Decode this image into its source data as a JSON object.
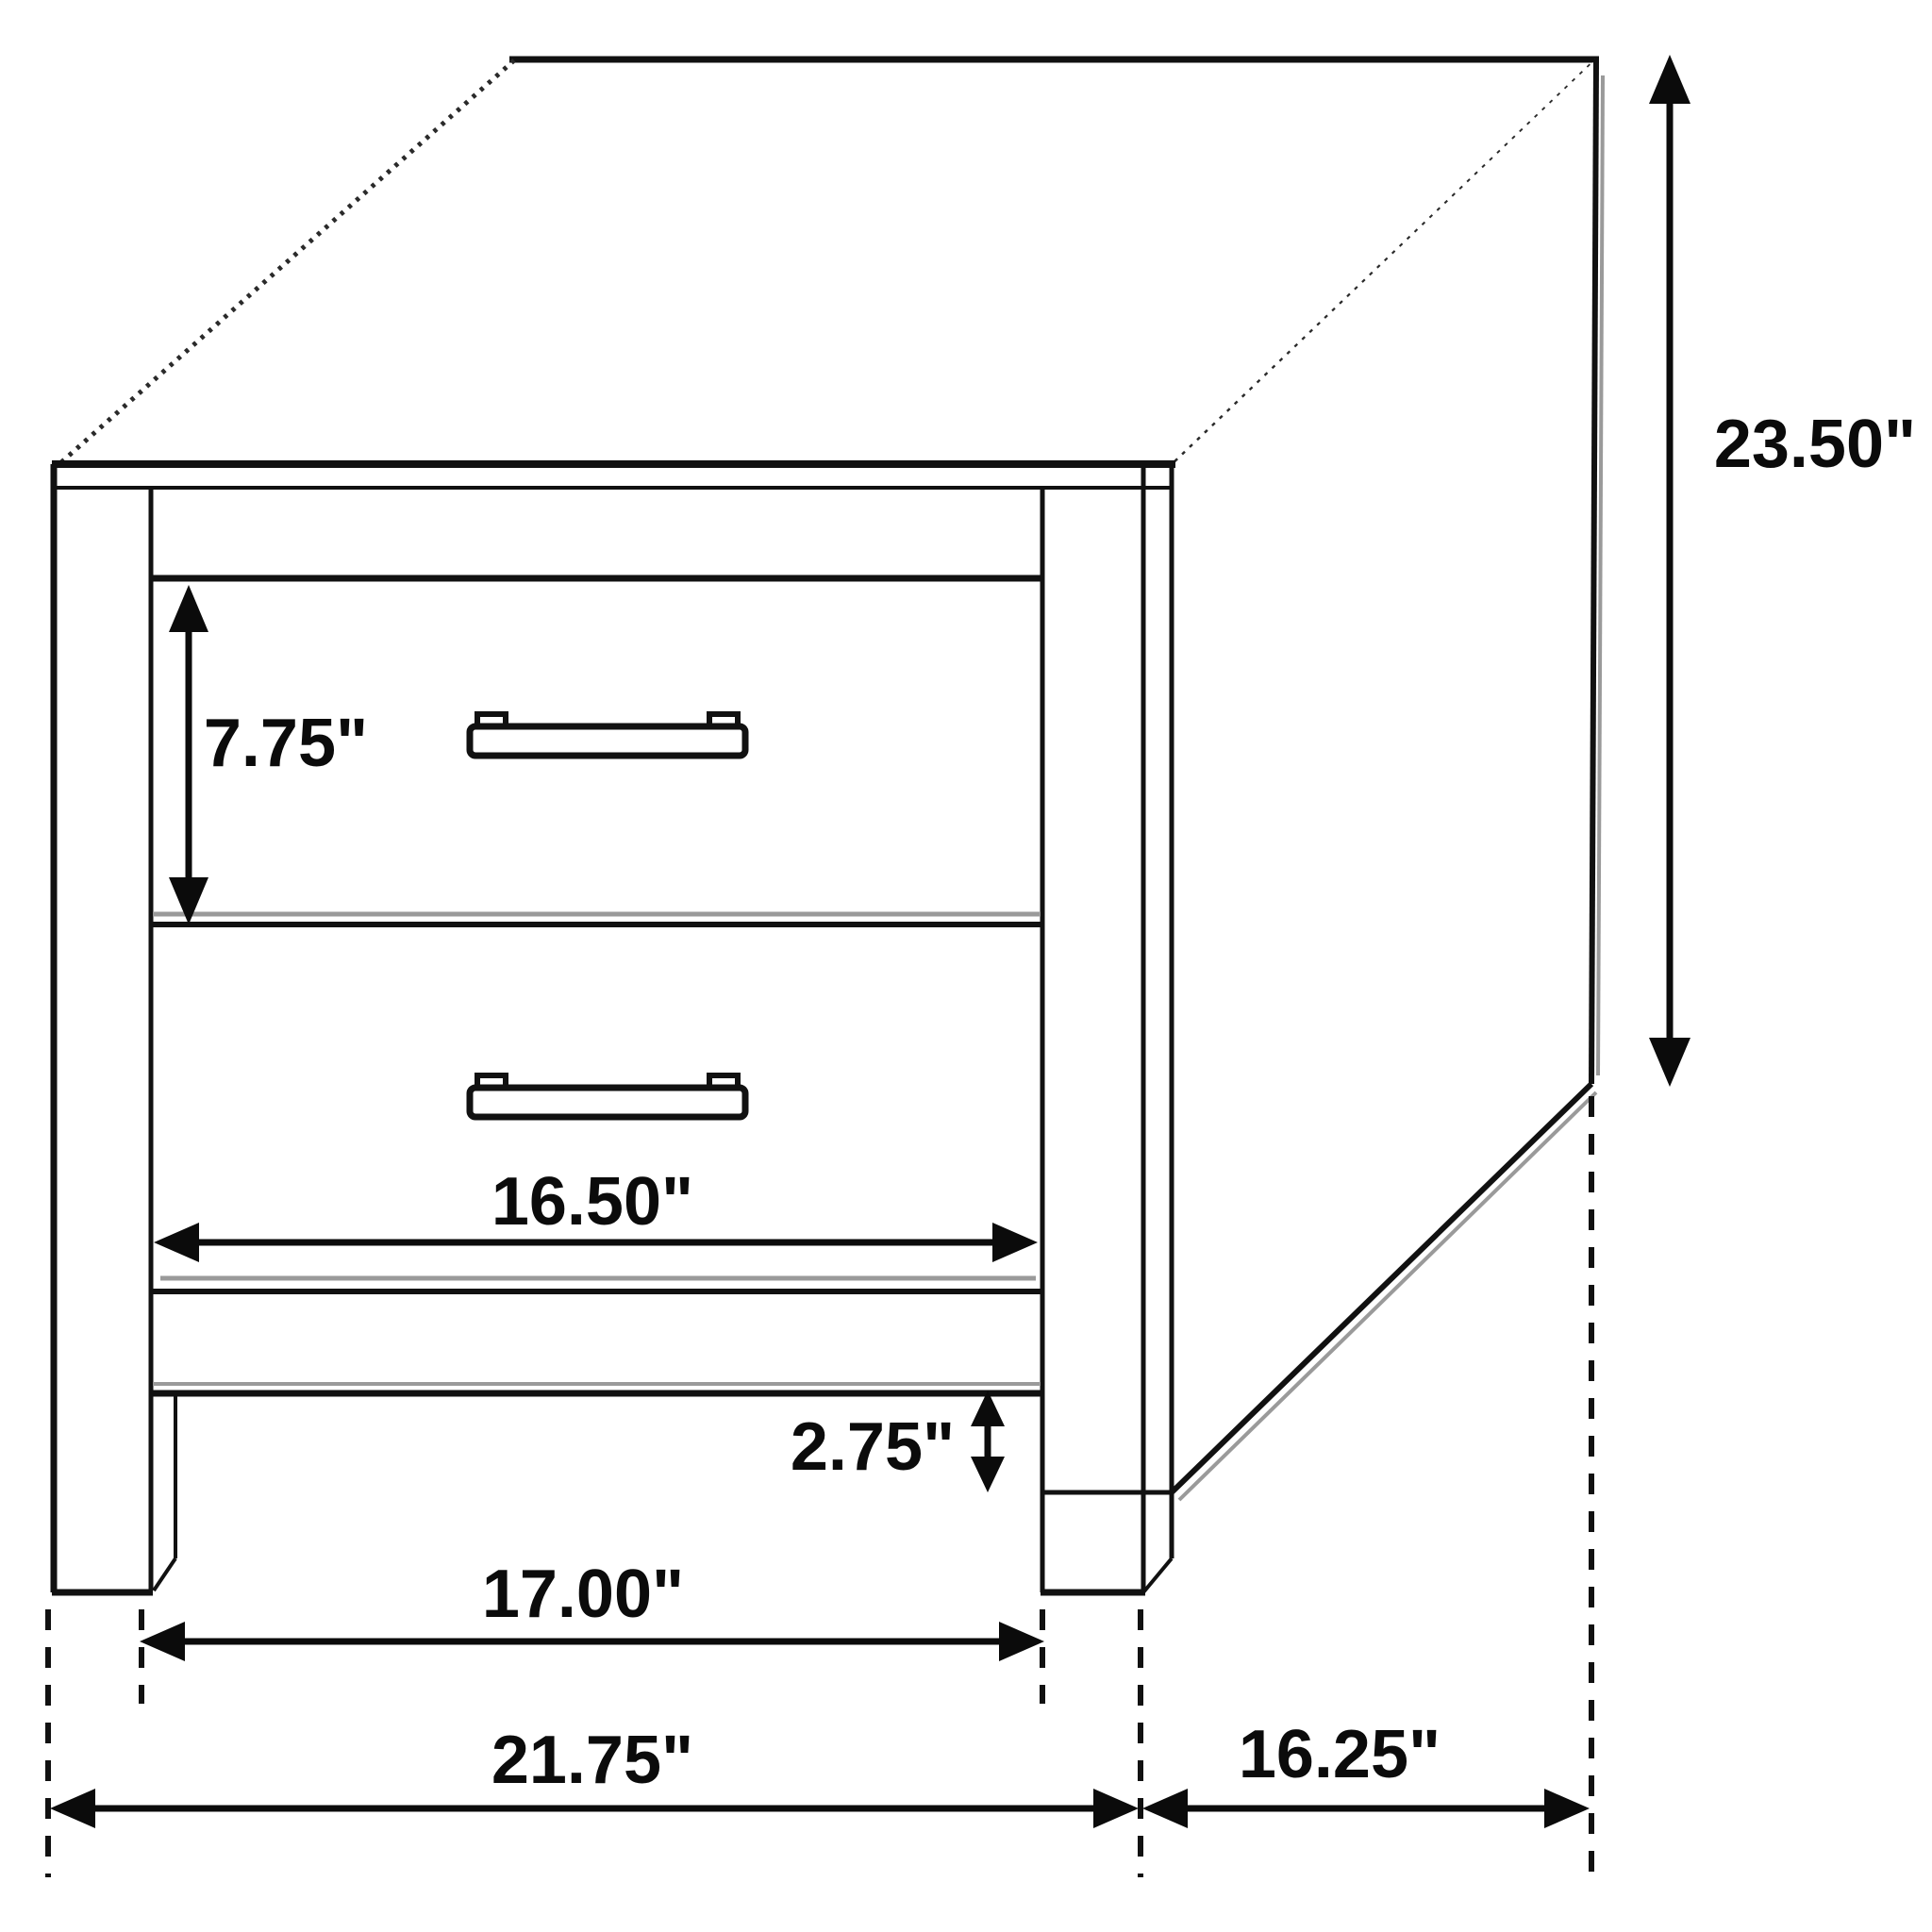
{
  "diagram": {
    "subject": "2-drawer nightstand dimensional line drawing",
    "unit": "inches",
    "line_color": "#111111",
    "background_color": "#ffffff",
    "dimensions": {
      "overall_height": "23.50\"",
      "top_drawer_height": "7.75\"",
      "drawer_front_width": "16.50\"",
      "foot_height": "2.75\"",
      "inner_leg_span": "17.00\"",
      "overall_width": "21.75\"",
      "overall_depth": "16.25\""
    }
  }
}
